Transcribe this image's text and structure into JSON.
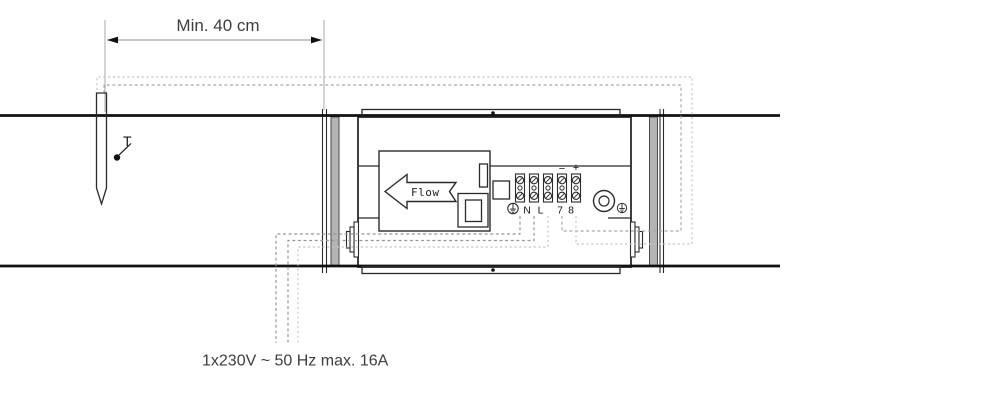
{
  "labels": {
    "dimension": "Min. 40 cm",
    "sensor": "T",
    "flow": "Flow",
    "power_rating": "1x230V ~ 50 Hz max. 16A"
  },
  "terminals": {
    "minus": "−",
    "plus": "+",
    "neutral": "N",
    "line": "L",
    "t7": "7",
    "t8": "8"
  },
  "icons": {
    "earth_terminal": "earth-ground-icon",
    "flow_arrow": "flow-direction-left-arrow",
    "temperature_probe": "temperature-sensor-probe",
    "terminal_screw": "slotted-screw-icon"
  },
  "colors": {
    "stroke": "#2a2a2a",
    "duct": "#111111",
    "collar_fill": "#b4b4b4",
    "dash_dark": "#969696",
    "dash_mid": "#a8a8a8",
    "dash_light": "#c4c4c4",
    "dim_line": "#8c8c8c",
    "dim_ext": "#aaaaaa",
    "text": "#3d3d3d"
  }
}
